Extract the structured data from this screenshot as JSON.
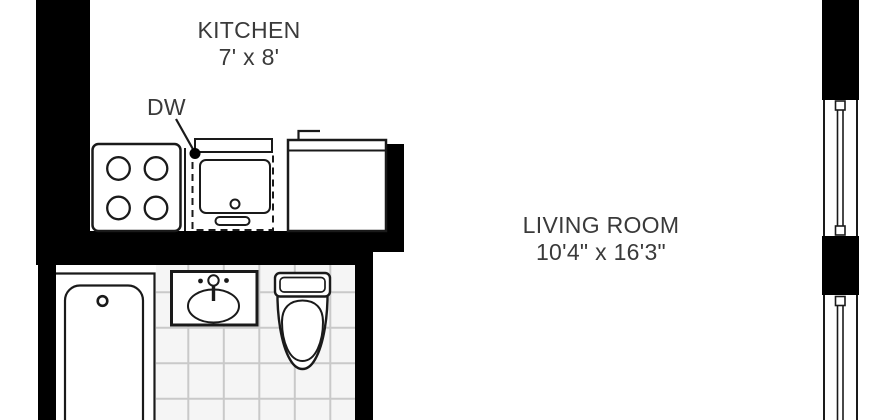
{
  "plan": {
    "kitchen": {
      "label": "KITCHEN",
      "dimensions": "7' x 8'"
    },
    "living_room": {
      "label": "LIVING ROOM",
      "dimensions": "10'4\" x 16'3\""
    },
    "dishwasher_label": "DW",
    "fixtures": {
      "stove": "4-burner stove",
      "dishwasher": "dishwasher (dashed outline)",
      "kitchen_sink": "kitchen sink counter with faucet",
      "bathtub": "bathtub",
      "bathroom_sink": "bathroom sink",
      "toilet": "toilet"
    },
    "windows": {
      "count": 2,
      "location": "right wall"
    },
    "colors": {
      "wall": "#000000",
      "line": "#1a1a1a",
      "tile_fill": "#f5f5f5",
      "tile_grout": "#c9c9c9",
      "text": "#3a3a3a",
      "background": "#ffffff"
    }
  }
}
